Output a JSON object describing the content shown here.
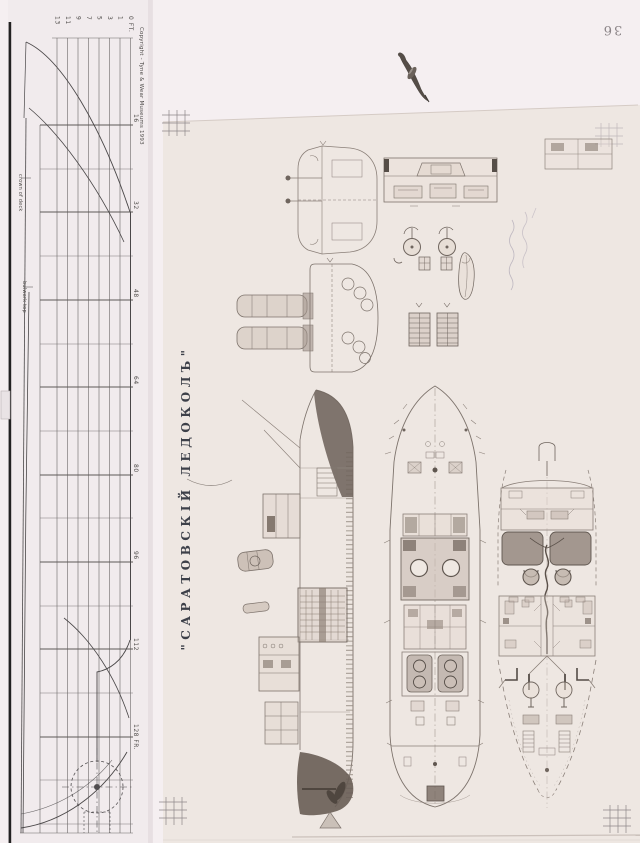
{
  "page": {
    "number": "36"
  },
  "lines_plan": {
    "copyright": "Copyright - Tyne & Wear Museums 1993",
    "waterline_labels": [
      "13",
      "11",
      "9",
      "7",
      "5",
      "3",
      "1",
      "0 FT."
    ],
    "frame_labels": [
      "16",
      "32",
      "48",
      "64",
      "80",
      "96",
      "112",
      "128 FR."
    ],
    "curve_labels": {
      "crown_of_deck": "crown of deck",
      "bulwark_top": "bulwark top"
    }
  },
  "sheet": {
    "title": "\"САРАТОВСКІЙ  ЛЕДОКОЛЪ\"",
    "drawings": [
      "body-section-end-view",
      "boiler-and-funnel-section",
      "bridge-deck-plan-fragment",
      "inboard-profile",
      "upper-deck-plan",
      "lower-deck-plan"
    ]
  },
  "colors": {
    "page_bg": "#f5eff1",
    "strip_bg": "#f1ebed",
    "sheet_bg": "#eee7e2",
    "pencil": "#8a7f78",
    "ink_dark": "#5f564f",
    "title_ink": "#3d4049"
  }
}
